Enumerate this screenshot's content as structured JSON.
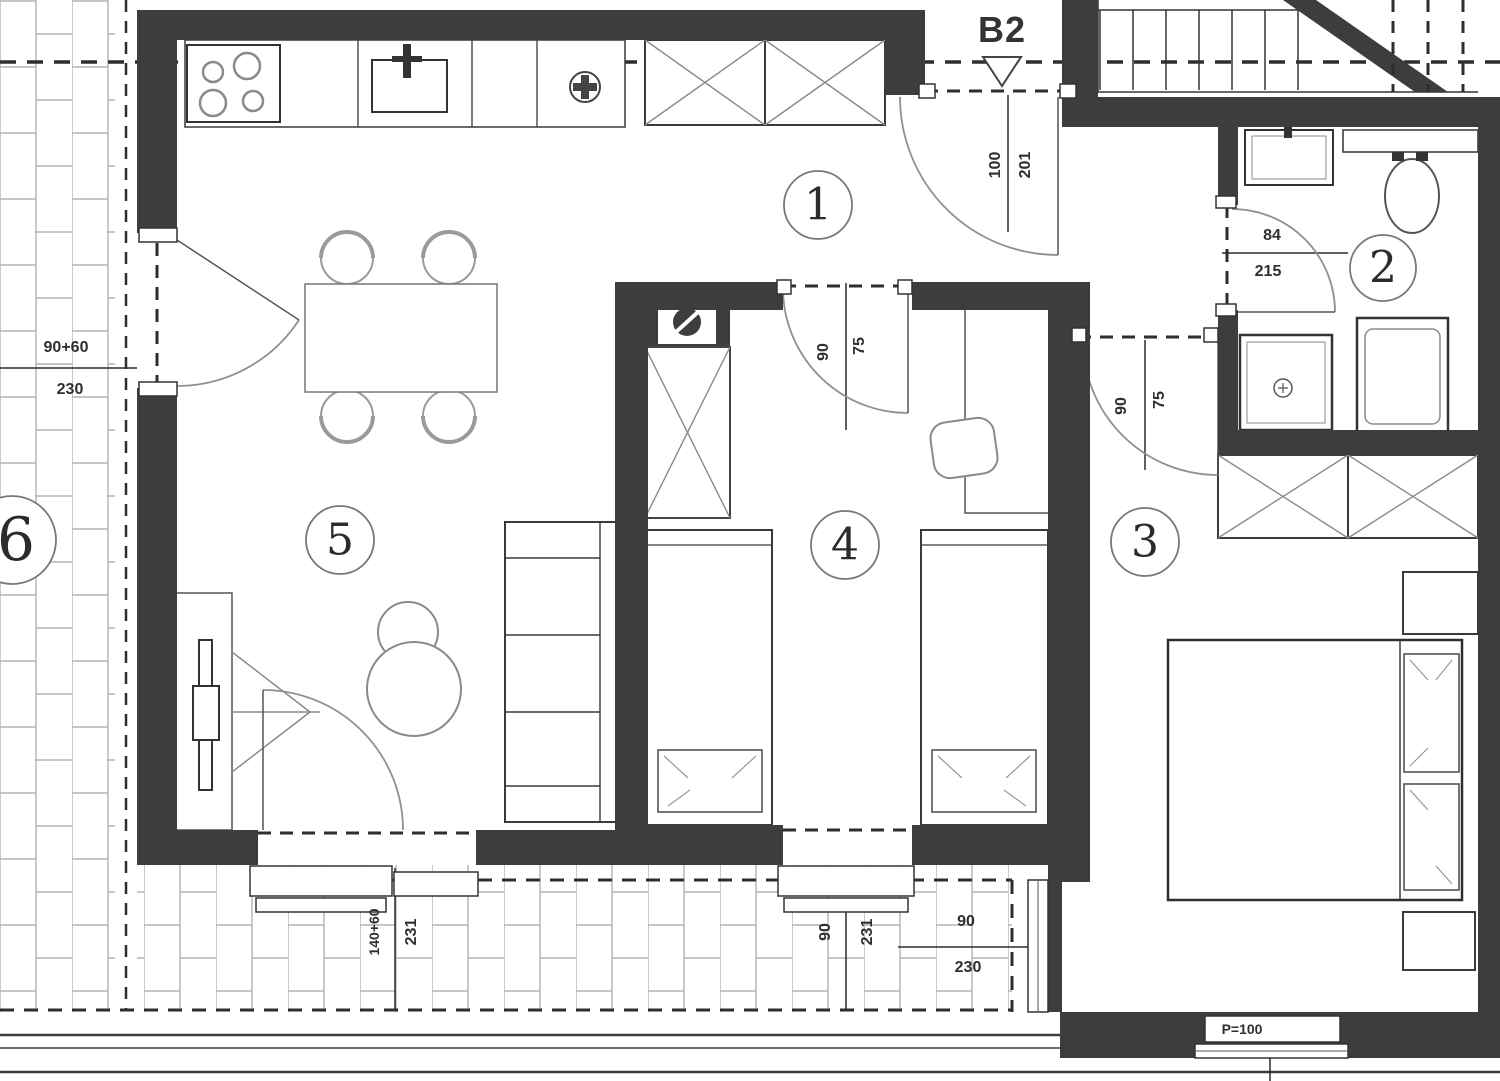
{
  "floorplan": {
    "unit_label": "B2",
    "rooms": [
      {
        "number": "1"
      },
      {
        "number": "2"
      },
      {
        "number": "3"
      },
      {
        "number": "4"
      },
      {
        "number": "5"
      },
      {
        "number": "6"
      }
    ],
    "dimensions": {
      "entrance_door": {
        "width": "100",
        "height": "201"
      },
      "bedroom4_door": {
        "width": "90",
        "height": "75"
      },
      "bedroom3_door": {
        "width": "90",
        "height": "75"
      },
      "bathroom_door": {
        "width": "84",
        "height": "215"
      },
      "living_side_window": {
        "width": "90+60",
        "height": "230"
      },
      "living_balcony_door": {
        "width": "140+60",
        "height": "231"
      },
      "bedroom4_window": {
        "width": "90",
        "height": "231"
      },
      "bedroom3_window": {
        "width": "90",
        "height": "230"
      },
      "parapet_label": "P=100"
    },
    "colors": {
      "wall": "#3d3d3d",
      "dark_line": "#2e2e2e",
      "light_line": "#9a9a9a",
      "brick_line": "#b3b3b3",
      "background": "#ffffff"
    }
  }
}
